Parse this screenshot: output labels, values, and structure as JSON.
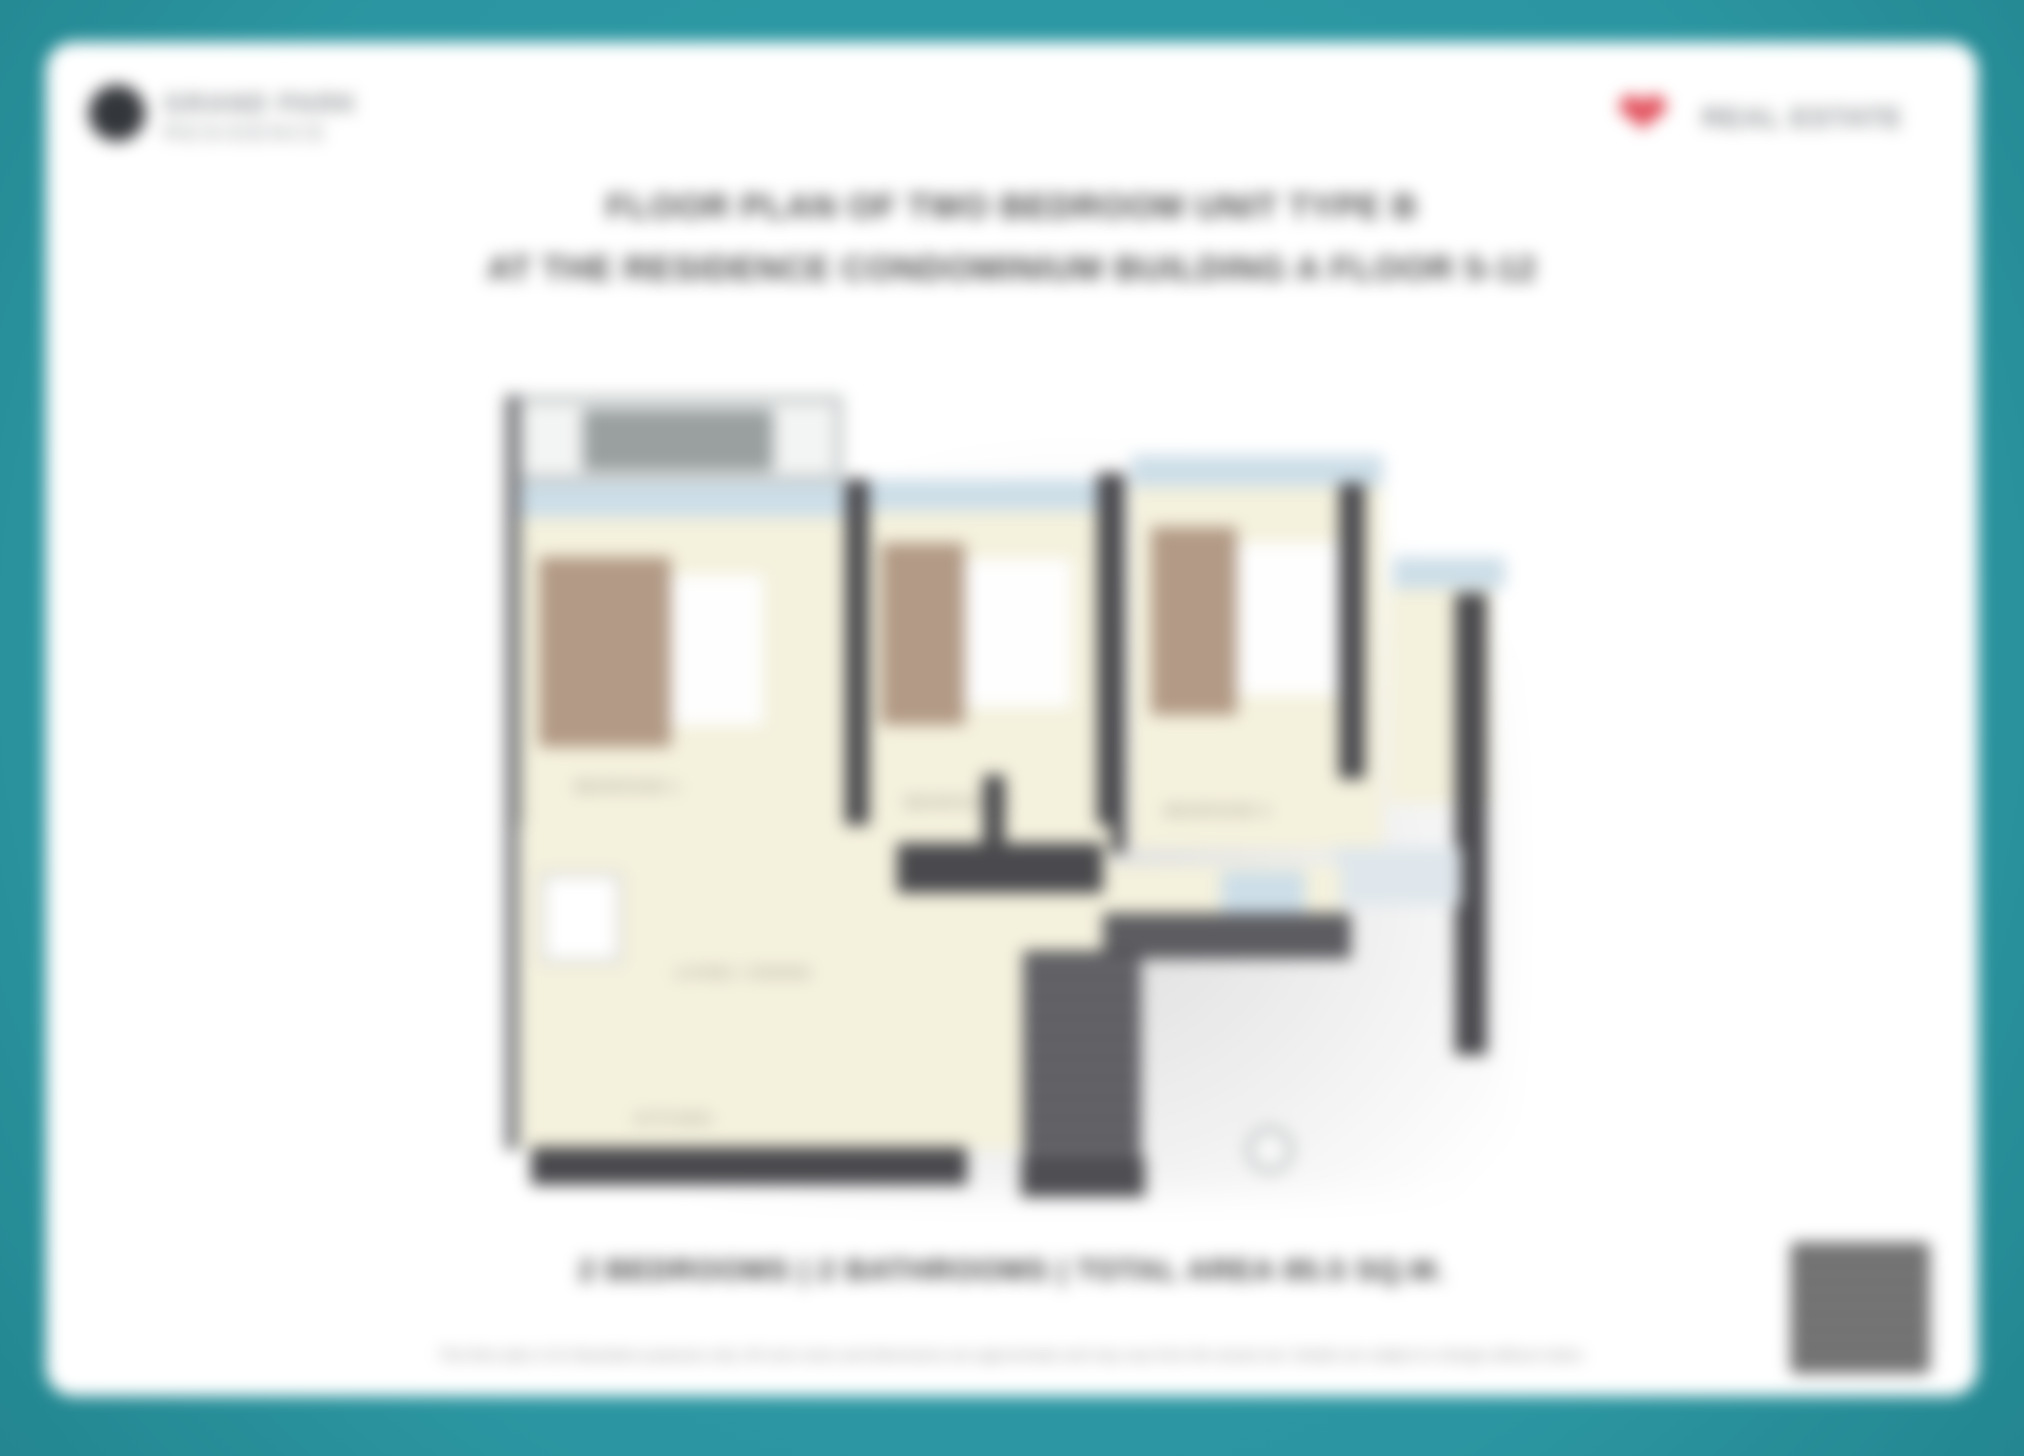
{
  "colors": {
    "teal": "#2b96a1",
    "teal_light": "#2f9da8",
    "teal_dark": "#238690",
    "page": "#ffffff",
    "title_text": "#4a4a4a",
    "summary_text": "#3f3f3f",
    "fineprint": "#8f8f8f",
    "logo_dark": "#33363a",
    "logo_text": "#8c9093",
    "heart_red": "#e2505c",
    "wall": "#4a4a4e",
    "floor_cream": "#f4f1dd",
    "window_blue": "#cddee8",
    "bed_tan": "#b29a86",
    "duvet_white": "#fefefe",
    "balcony_gray": "#9aa0a0",
    "qr_dark": "#5a5a5a",
    "label_gray": "#9a948a"
  },
  "header": {
    "left_logo": {
      "icon": "building-emblem",
      "line1": "GRAND PARK",
      "line2": "RESIDENCE"
    },
    "right_logo": {
      "icon": "heart",
      "text": "REAL ESTATE"
    }
  },
  "title": {
    "line1": "FLOOR PLAN OF TWO BEDROOM UNIT TYPE B",
    "line2": "AT THE RESIDENCE CONDOMINIUM BUILDING A FLOOR 5-12"
  },
  "floor_plan": {
    "labels": {
      "bedroom1": "BEDROOM 1",
      "bedroom2": "BEDROOM 2",
      "bedroom3": "BEDROOM 3",
      "living": "LIVING / DINING",
      "kitchen": "KITCHEN"
    }
  },
  "summary": {
    "text": "2 BEDROOMS  |  2 BATHROOMS  |  TOTAL AREA 85.5 SQ.M."
  },
  "disclaimer": {
    "text": "This floor plan is for illustrative purposes only. All room sizes and dimensions are approximate and may vary from the actual unit. Details are subject to change without notice."
  }
}
